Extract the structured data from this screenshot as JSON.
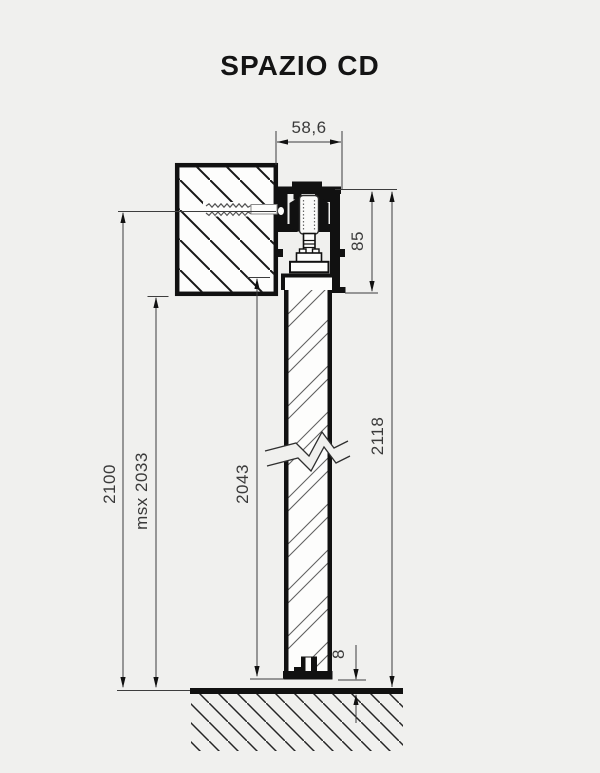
{
  "title": "SPAZIO CD",
  "labels": {
    "width": "58,6",
    "track_height": "85",
    "total_height": "2118",
    "door_height": "2043",
    "max_door": "msx 2033",
    "install_height": "2100",
    "floor_gap": "8"
  },
  "colors": {
    "background": "#f0f0ee",
    "ink": "#161616",
    "dim_ink": "#3d3d3d"
  }
}
